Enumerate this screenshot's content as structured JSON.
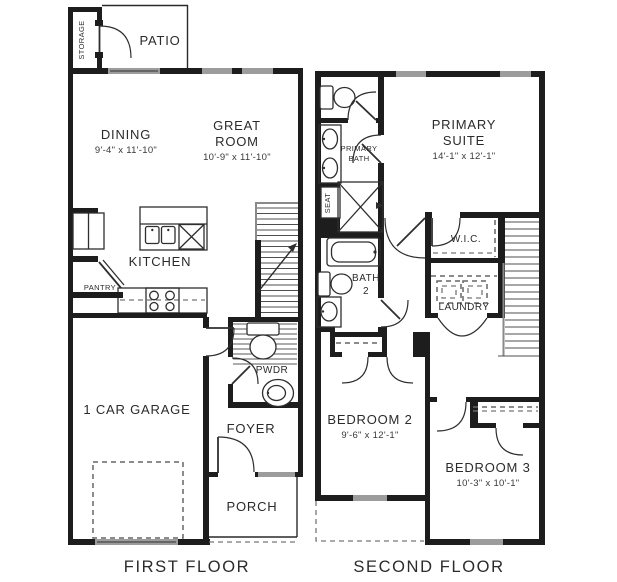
{
  "floors": {
    "first": {
      "title": "FIRST FLOOR",
      "rooms": {
        "storage": "STORAGE",
        "patio": "PATIO",
        "dining": "DINING",
        "dining_dims": "9'-4\" x 11'-10\"",
        "great1": "GREAT",
        "great2": "ROOM",
        "great_dims": "10'-9\" x 11'-10\"",
        "kitchen": "KITCHEN",
        "pantry": "PANTRY",
        "pwdr": "PWDR",
        "garage": "1 CAR GARAGE",
        "foyer": "FOYER",
        "porch": "PORCH"
      }
    },
    "second": {
      "title": "SECOND FLOOR",
      "rooms": {
        "primary1": "PRIMARY",
        "primary2": "SUITE",
        "primary_dims": "14'-1\" x 12'-1\"",
        "primary_bath1": "PRIMARY",
        "primary_bath2": "BATH",
        "seat": "SEAT",
        "wic": "W.I.C.",
        "laundry": "LAUNDRY",
        "bath2_1": "BATH",
        "bath2_2": "2",
        "bedroom2": "BEDROOM 2",
        "bedroom2_dims": "9'-6\" x 12'-1\"",
        "bedroom3": "BEDROOM 3",
        "bedroom3_dims": "10'-3\" x 10'-1\""
      }
    }
  },
  "colors": {
    "wall": "#1d1d1d",
    "window": "#9c9c9c",
    "fixture": "#2e2e2e",
    "text": "#2b2b2b",
    "dash": "#666666",
    "background": "#ffffff"
  }
}
